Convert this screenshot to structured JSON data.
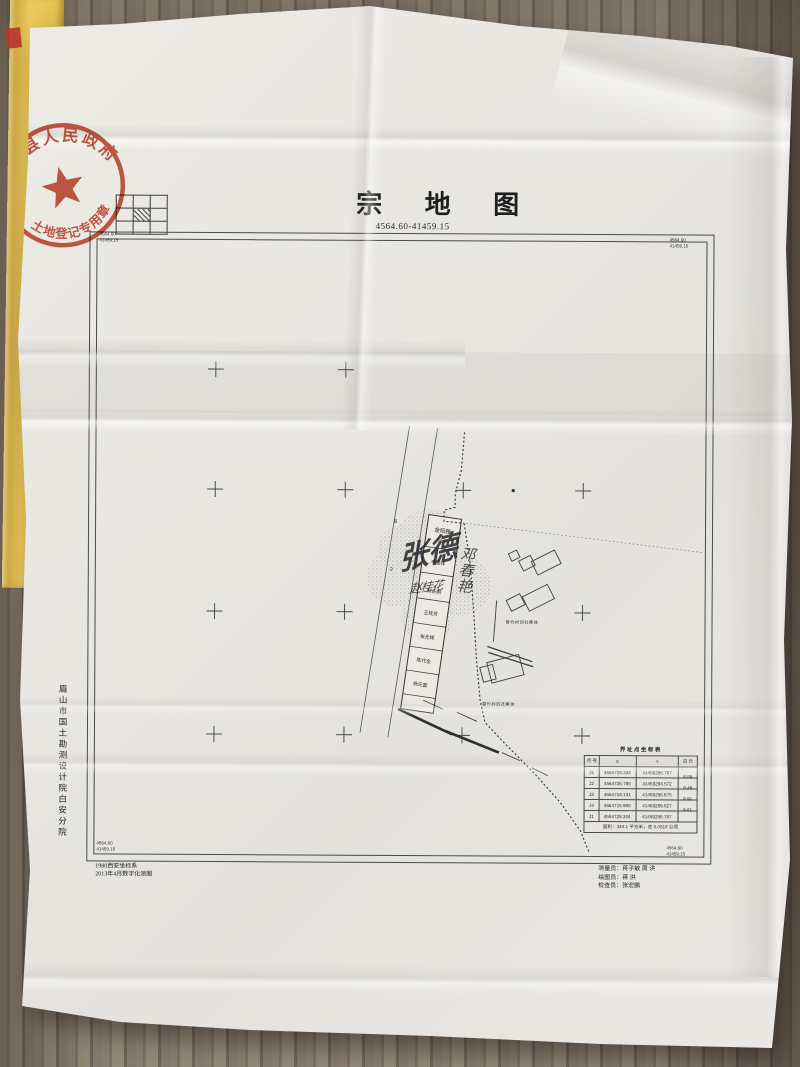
{
  "title_block": {
    "title": "宗  地  图",
    "subtitle": "4564.60-41459.15"
  },
  "seal": {
    "arc_text": "营山县人民政府",
    "bottom_text": "土地登记专用章"
  },
  "frame": {
    "corner_tl": [
      "4564.60",
      "41459.15"
    ],
    "corner_tr": [
      "4564.60",
      "41459.15"
    ],
    "corner_bl": [
      "4564.60",
      "41459.15"
    ],
    "corner_br": [
      "4564.60",
      "41459.15"
    ]
  },
  "map": {
    "strip_header": "金阳路",
    "strip_header_sub": "24-5",
    "strip_labels": [
      "李国祥",
      "刘长明",
      "王桂芳",
      "张光辉",
      "陈代全",
      "杨元富"
    ],
    "handwriting_main": "张德",
    "handwriting_side": "邓春艳",
    "handwriting_cell": "赵桂花",
    "neighbor_label_1": "营竹村四社集体",
    "neighbor_label_2": "营竹村四社集体",
    "road_number_1": "8",
    "road_number_2": "2"
  },
  "coord_table": {
    "title": "界址点坐标表",
    "headers": [
      "点 号",
      "X",
      "Y",
      "边 长"
    ],
    "rows": [
      {
        "id": "J1",
        "x": "4564728.334",
        "y": "41459296.787",
        "len": "8.89"
      },
      {
        "id": "J2",
        "x": "4564726.786",
        "y": "41459294.572",
        "len": "8.48"
      },
      {
        "id": "J3",
        "x": "4564718.131",
        "y": "41459296.875",
        "len": "8.91"
      },
      {
        "id": "J4",
        "x": "4564715.980",
        "y": "41459289.827",
        "len": "8.61"
      },
      {
        "id": "J1",
        "x": "4564728.334",
        "y": "41459296.787",
        "len": ""
      }
    ],
    "footer": "面积：344.1 平方米，合 0.0516 公顷"
  },
  "footer": {
    "org_vertical": "眉山市国土勘测设计院白安分院",
    "note_1": "1980西安坐标系",
    "note_2": "2013年4月数字化测图",
    "credit_1": "测量员：蒋子敏  周 洪",
    "credit_2": "绘图员：蒋  洪",
    "credit_3": "检查员：张宏鹏"
  }
}
